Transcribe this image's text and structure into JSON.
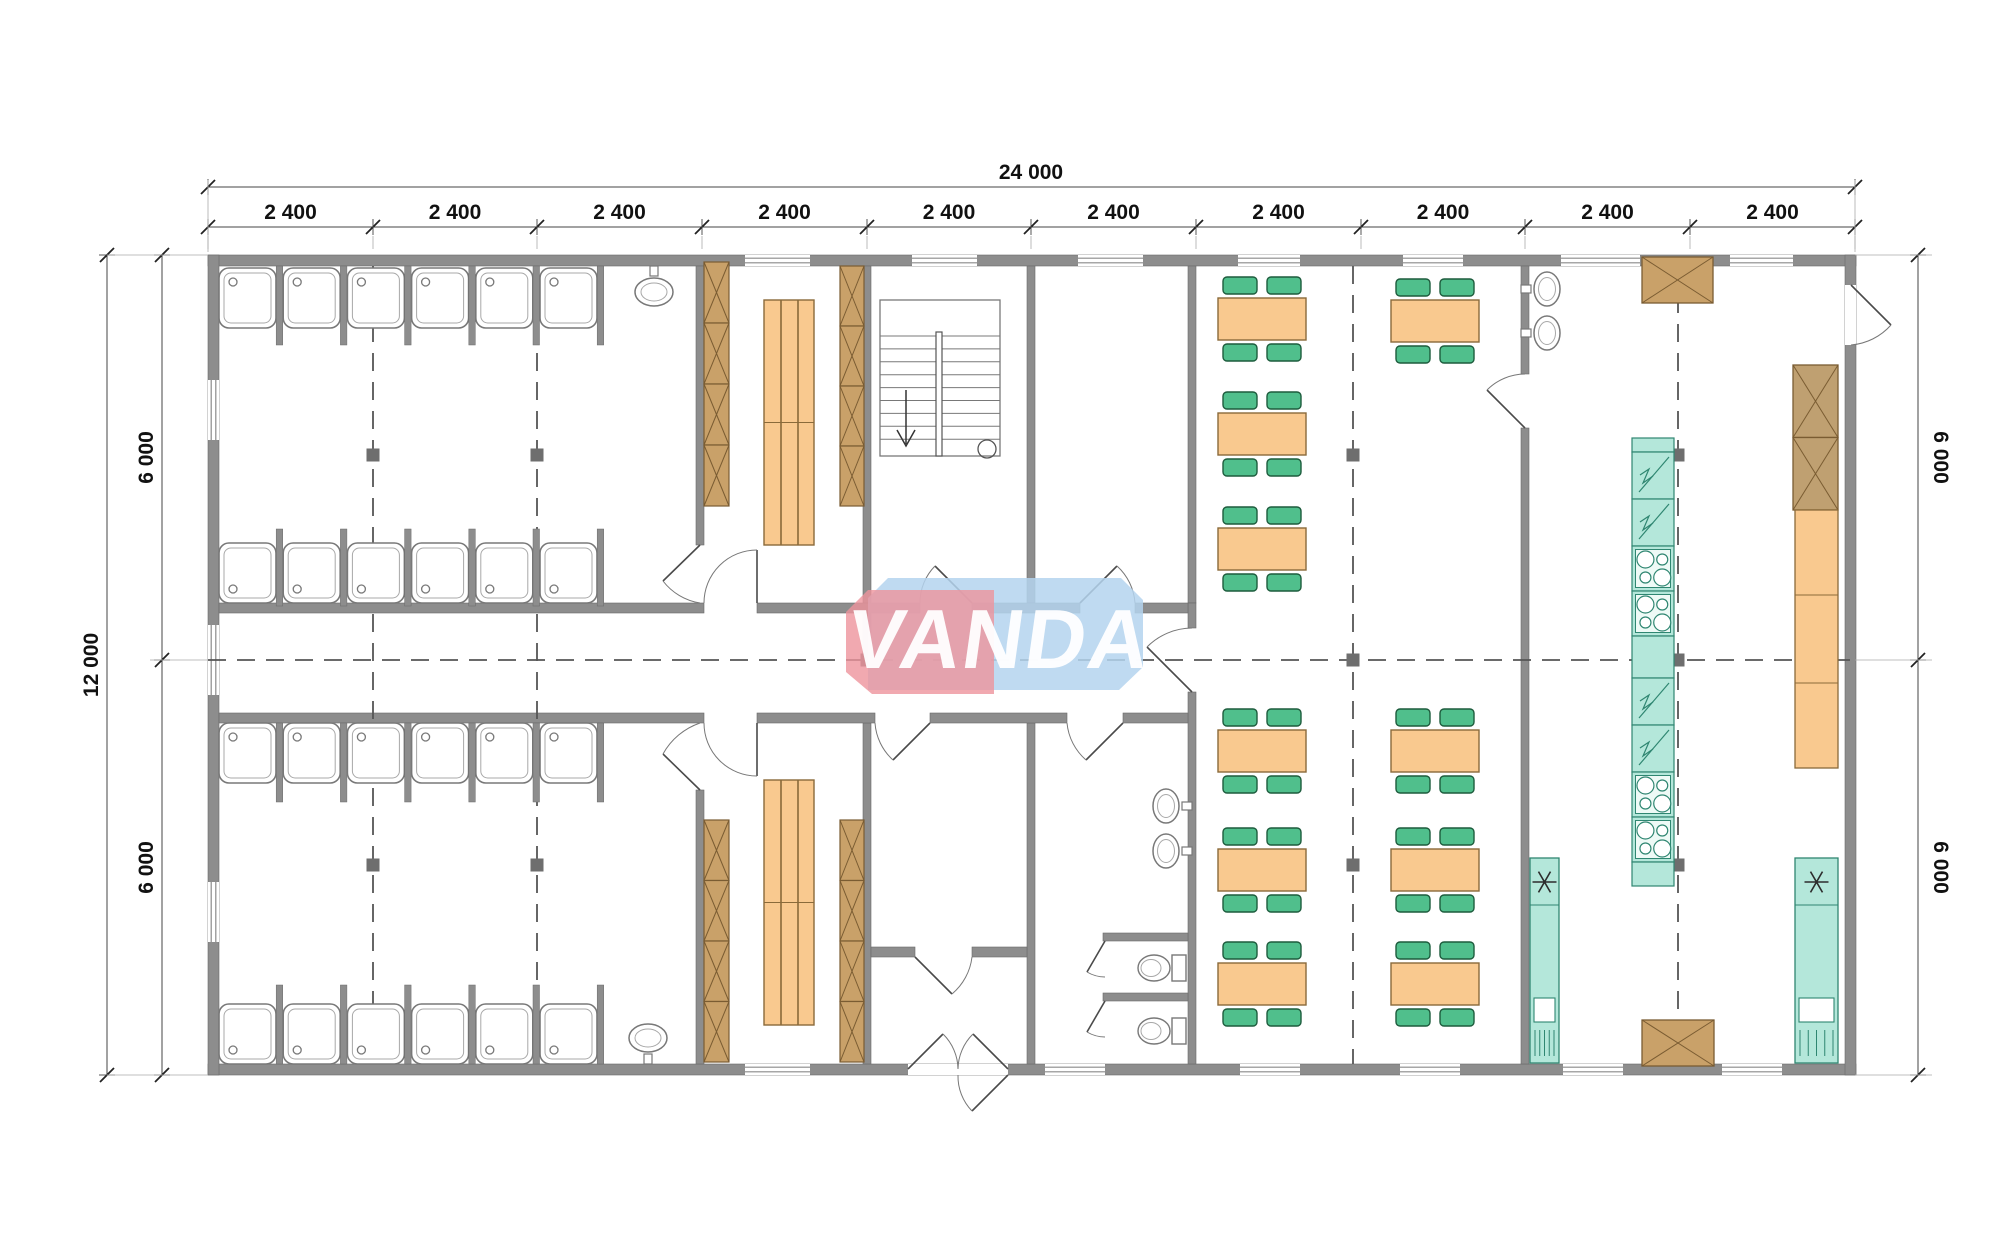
{
  "watermark": {
    "text": "VANDA",
    "pink_color": "rgba(238,148,156,0.80)",
    "blue_color": "rgba(180,211,238,0.85)"
  },
  "dimensions": {
    "top_total": "24 000",
    "top_segments": [
      "2 400",
      "2 400",
      "2 400",
      "2 400",
      "2 400",
      "2 400",
      "2 400",
      "2 400",
      "2 400",
      "2 400"
    ],
    "left_total": "12 000",
    "left_segments": [
      "6 000",
      "6 000"
    ],
    "right_segments": [
      "6 000",
      "6 000"
    ]
  },
  "colors": {
    "wall": "#8d8d8d",
    "wall_edge": "#6a6a6a",
    "column": "#6e6e6e",
    "fixture_line": "#787878",
    "stall_inner": "#a8a8a8",
    "wood": "#c9a169",
    "wood_line": "#7a5c32",
    "table": "#f9c98f",
    "table_line": "#8a6a3a",
    "chair": "#50bf8c",
    "chair_line": "#1d5c3d",
    "appliance": "#b4e7da",
    "appliance_line": "#2f8671",
    "appliance_panel": "#eefaf6",
    "dash": "#555555",
    "door_line": "#4a4a4a",
    "dim_line": "#444444",
    "window_line": "#8a8a8a"
  },
  "geometry": {
    "bounds": [
      208,
      255,
      1648,
      820
    ],
    "walls_ext": [
      [
        208,
        255,
        1648,
        11
      ],
      [
        208,
        1064,
        1648,
        11
      ],
      [
        208,
        255,
        11,
        820
      ],
      [
        1845,
        255,
        11,
        820
      ]
    ],
    "walls_int": [
      [
        696,
        266,
        8,
        279
      ],
      [
        696,
        790,
        8,
        274
      ],
      [
        863,
        266,
        8,
        392
      ],
      [
        863,
        723,
        8,
        341
      ],
      [
        1027,
        266,
        8,
        337
      ],
      [
        1027,
        723,
        8,
        341
      ],
      [
        1188,
        266,
        8,
        337
      ],
      [
        1188,
        603,
        8,
        25
      ],
      [
        1188,
        692,
        8,
        372
      ],
      [
        1521,
        266,
        8,
        108
      ],
      [
        1521,
        428,
        8,
        636
      ],
      [
        219,
        603,
        485,
        10
      ],
      [
        757,
        603,
        163,
        10
      ],
      [
        972,
        603,
        108,
        10
      ],
      [
        1135,
        603,
        53,
        10
      ],
      [
        219,
        713,
        485,
        10
      ],
      [
        757,
        713,
        118,
        10
      ],
      [
        930,
        713,
        137,
        10
      ],
      [
        1123,
        713,
        65,
        10
      ],
      [
        871,
        947,
        44,
        10
      ],
      [
        972,
        947,
        55,
        10
      ],
      [
        1103,
        933,
        85,
        8
      ],
      [
        1103,
        993,
        85,
        8
      ]
    ],
    "windows_top": [
      [
        745,
        65
      ],
      [
        912,
        65
      ],
      [
        1078,
        65
      ],
      [
        1238,
        62
      ],
      [
        1403,
        60
      ],
      [
        1561,
        79
      ],
      [
        1730,
        63
      ]
    ],
    "windows_bottom": [
      [
        745,
        65
      ],
      [
        1045,
        60
      ],
      [
        1240,
        60
      ],
      [
        1400,
        60
      ],
      [
        1563,
        60
      ],
      [
        1722,
        60
      ]
    ],
    "windows_left": [
      [
        380,
        60
      ],
      [
        625,
        70
      ],
      [
        882,
        60
      ]
    ],
    "door_whiteouts": [
      [
        1845,
        285,
        11,
        60
      ],
      [
        908,
        1064,
        100,
        11
      ]
    ],
    "grid_x": [
      208,
      373,
      537,
      702,
      867,
      1031,
      1196,
      1361,
      1525,
      1690,
      1855
    ],
    "dash_vertical": [
      373,
      537,
      1353,
      1678
    ],
    "dash_horizontal_y": 660,
    "columns": [
      [
        373,
        455
      ],
      [
        537,
        455
      ],
      [
        373,
        865
      ],
      [
        537,
        865
      ],
      [
        867,
        660
      ],
      [
        1353,
        455
      ],
      [
        1353,
        660
      ],
      [
        1353,
        865
      ],
      [
        1678,
        455
      ],
      [
        1678,
        660
      ],
      [
        1678,
        865
      ]
    ],
    "shower_x0": 219,
    "shower_pitch": 64.2,
    "shower_count": 6,
    "shower_w": 57,
    "shower_rows": [
      {
        "y": 268,
        "h": 60,
        "drain": "top",
        "py": 266,
        "plen": 79
      },
      {
        "y": 543,
        "h": 60,
        "drain": "bottom",
        "py": 529,
        "plen": 77
      },
      {
        "y": 723,
        "h": 60,
        "drain": "top",
        "py": 723,
        "plen": 79
      },
      {
        "y": 1004,
        "h": 60,
        "drain": "bottom",
        "py": 985,
        "plen": 79
      }
    ],
    "washbasins": [
      [
        654,
        292,
        "up"
      ],
      [
        648,
        1038,
        "down"
      ],
      [
        1166,
        806,
        "right"
      ],
      [
        1166,
        851,
        "right"
      ],
      [
        1547,
        289,
        "left"
      ],
      [
        1547,
        333,
        "left"
      ]
    ],
    "toilets": [
      [
        1152,
        968
      ],
      [
        1152,
        1031
      ]
    ],
    "lockers": [
      [
        704,
        262,
        25,
        244
      ],
      [
        840,
        266,
        24,
        240
      ],
      [
        704,
        820,
        25,
        242
      ],
      [
        840,
        820,
        24,
        242
      ]
    ],
    "benches": [
      [
        764,
        300,
        50,
        245
      ],
      [
        764,
        780,
        50,
        245
      ]
    ],
    "tables": [
      [
        1218,
        298
      ],
      [
        1218,
        413
      ],
      [
        1218,
        528
      ],
      [
        1391,
        300
      ],
      [
        1218,
        730
      ],
      [
        1391,
        730
      ],
      [
        1218,
        849
      ],
      [
        1391,
        849
      ],
      [
        1218,
        963
      ],
      [
        1391,
        963
      ]
    ],
    "table_size": [
      88,
      42
    ],
    "stairs": {
      "x": 880,
      "y": 300,
      "w": 120,
      "h": 156,
      "treads": 9,
      "rail_x": 936,
      "arrow_x": 906,
      "circle": [
        987,
        449
      ]
    },
    "island": {
      "x": 1632,
      "y": 438,
      "w": 42,
      "panels": [
        [
          14,
          "plain"
        ],
        [
          47,
          "fridge"
        ],
        [
          47,
          "fridge"
        ],
        [
          45,
          "stove"
        ],
        [
          45,
          "stove"
        ],
        [
          42,
          "plain"
        ],
        [
          47,
          "fridge"
        ],
        [
          47,
          "fridge"
        ],
        [
          45,
          "stove"
        ],
        [
          45,
          "stove"
        ],
        [
          24,
          "plain"
        ]
      ]
    },
    "cold_units": [
      [
        1530,
        858,
        29,
        205
      ],
      [
        1795,
        858,
        43,
        205
      ]
    ],
    "wood_boxes": [
      [
        1642,
        257,
        71,
        46
      ],
      [
        1642,
        1020,
        72,
        46
      ]
    ],
    "tall_cabinet": {
      "x": 1793,
      "y": 365,
      "w": 45,
      "h": 145,
      "panels": 2
    },
    "counter": {
      "x": 1795,
      "y": 510,
      "w": 43,
      "h": 258,
      "dividers": [
        595,
        683
      ]
    },
    "doors": [
      [
        700,
        545,
        663,
        581,
        700,
        603
      ],
      [
        757,
        603,
        757,
        550,
        704,
        603
      ],
      [
        972,
        603,
        935,
        566,
        920,
        603
      ],
      [
        1080,
        603,
        1117,
        566,
        1135,
        603
      ],
      [
        700,
        790,
        663,
        754,
        700,
        723
      ],
      [
        757,
        723,
        757,
        776,
        704,
        723
      ],
      [
        915,
        957,
        952,
        994,
        972,
        957
      ],
      [
        930,
        723,
        893,
        760,
        875,
        723
      ],
      [
        1123,
        723,
        1086,
        760,
        1067,
        723
      ],
      [
        1192,
        692,
        1147,
        647,
        1192,
        628
      ],
      [
        1525,
        428,
        1487,
        390,
        1525,
        374
      ],
      [
        1851,
        285,
        1891,
        325,
        1851,
        345
      ],
      [
        908,
        1069,
        943,
        1034,
        958,
        1069
      ],
      [
        1008,
        1069,
        973,
        1034,
        958,
        1069
      ],
      [
        1008,
        1075,
        972,
        1111,
        958,
        1075
      ],
      [
        1105,
        941,
        1087,
        972,
        1105,
        977
      ],
      [
        1105,
        1001,
        1087,
        1032,
        1105,
        1037
      ]
    ],
    "dim_layout": {
      "top_total_y": 187,
      "top_seg_y": 227,
      "left_total_x": 107,
      "left_seg_x": 162,
      "right_seg_x": 1918,
      "y_top": 255,
      "y_mid": 660,
      "y_bot": 1075
    }
  }
}
